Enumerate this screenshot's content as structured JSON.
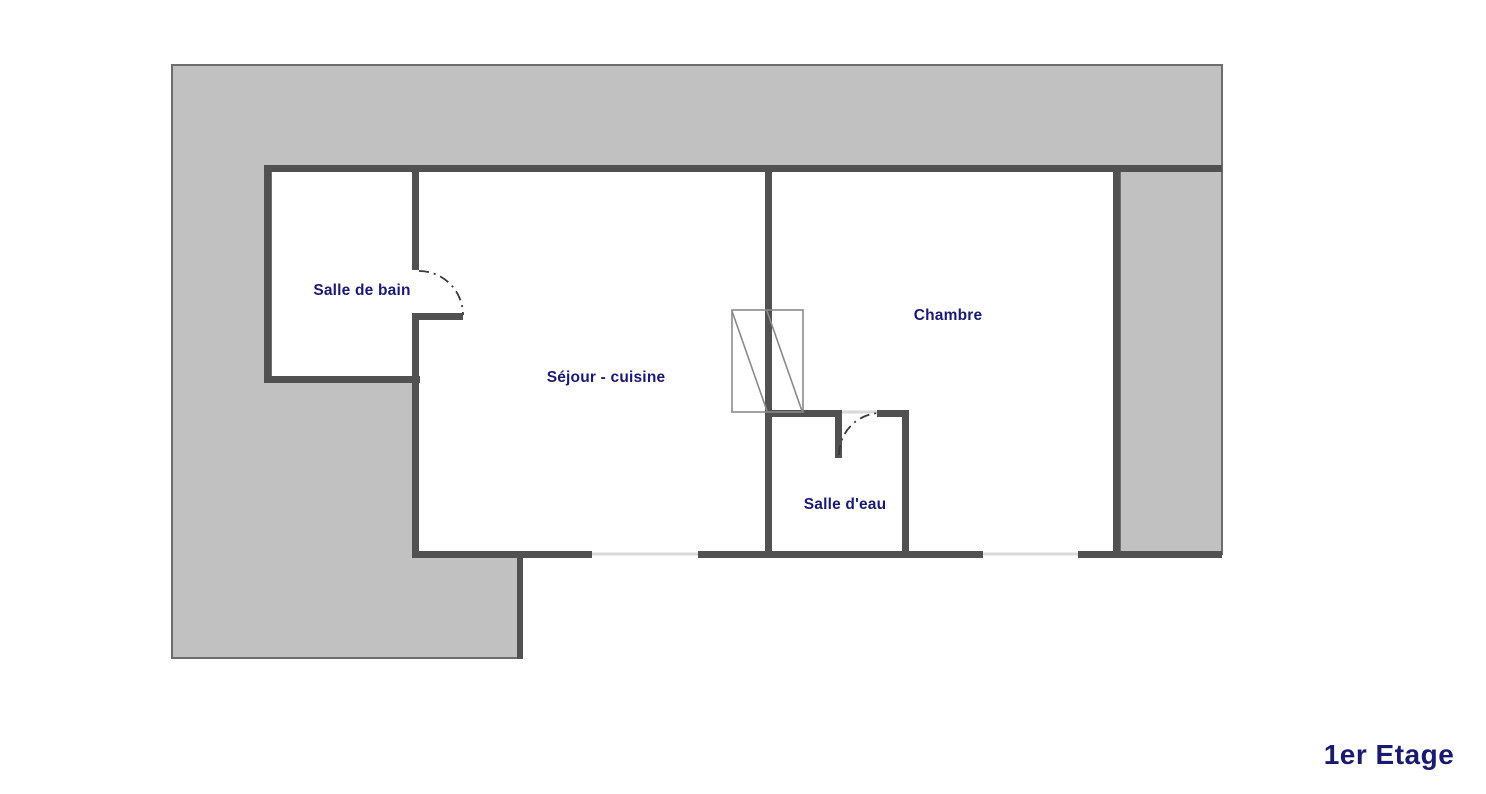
{
  "title": "1er Etage",
  "plan": {
    "rooms": [
      {
        "name": "salle-de-bain",
        "label": "Salle de bain"
      },
      {
        "name": "sejour-cuisine",
        "label": "Séjour - cuisine"
      },
      {
        "name": "chambre",
        "label": "Chambre"
      },
      {
        "name": "salle-d-eau",
        "label": "Salle d'eau"
      }
    ],
    "features": {
      "doors": 2,
      "windows": 2,
      "stair_symbols": 1
    }
  },
  "colors": {
    "mass-fill": "#c1c1c1",
    "mass-outline": "#6e6e6e",
    "wall": "#515151",
    "window-line": "#d9d9d9",
    "stairs-line": "#8a8a8a",
    "label-navy": "#1a1a70",
    "page-bg": "#ffffff"
  }
}
